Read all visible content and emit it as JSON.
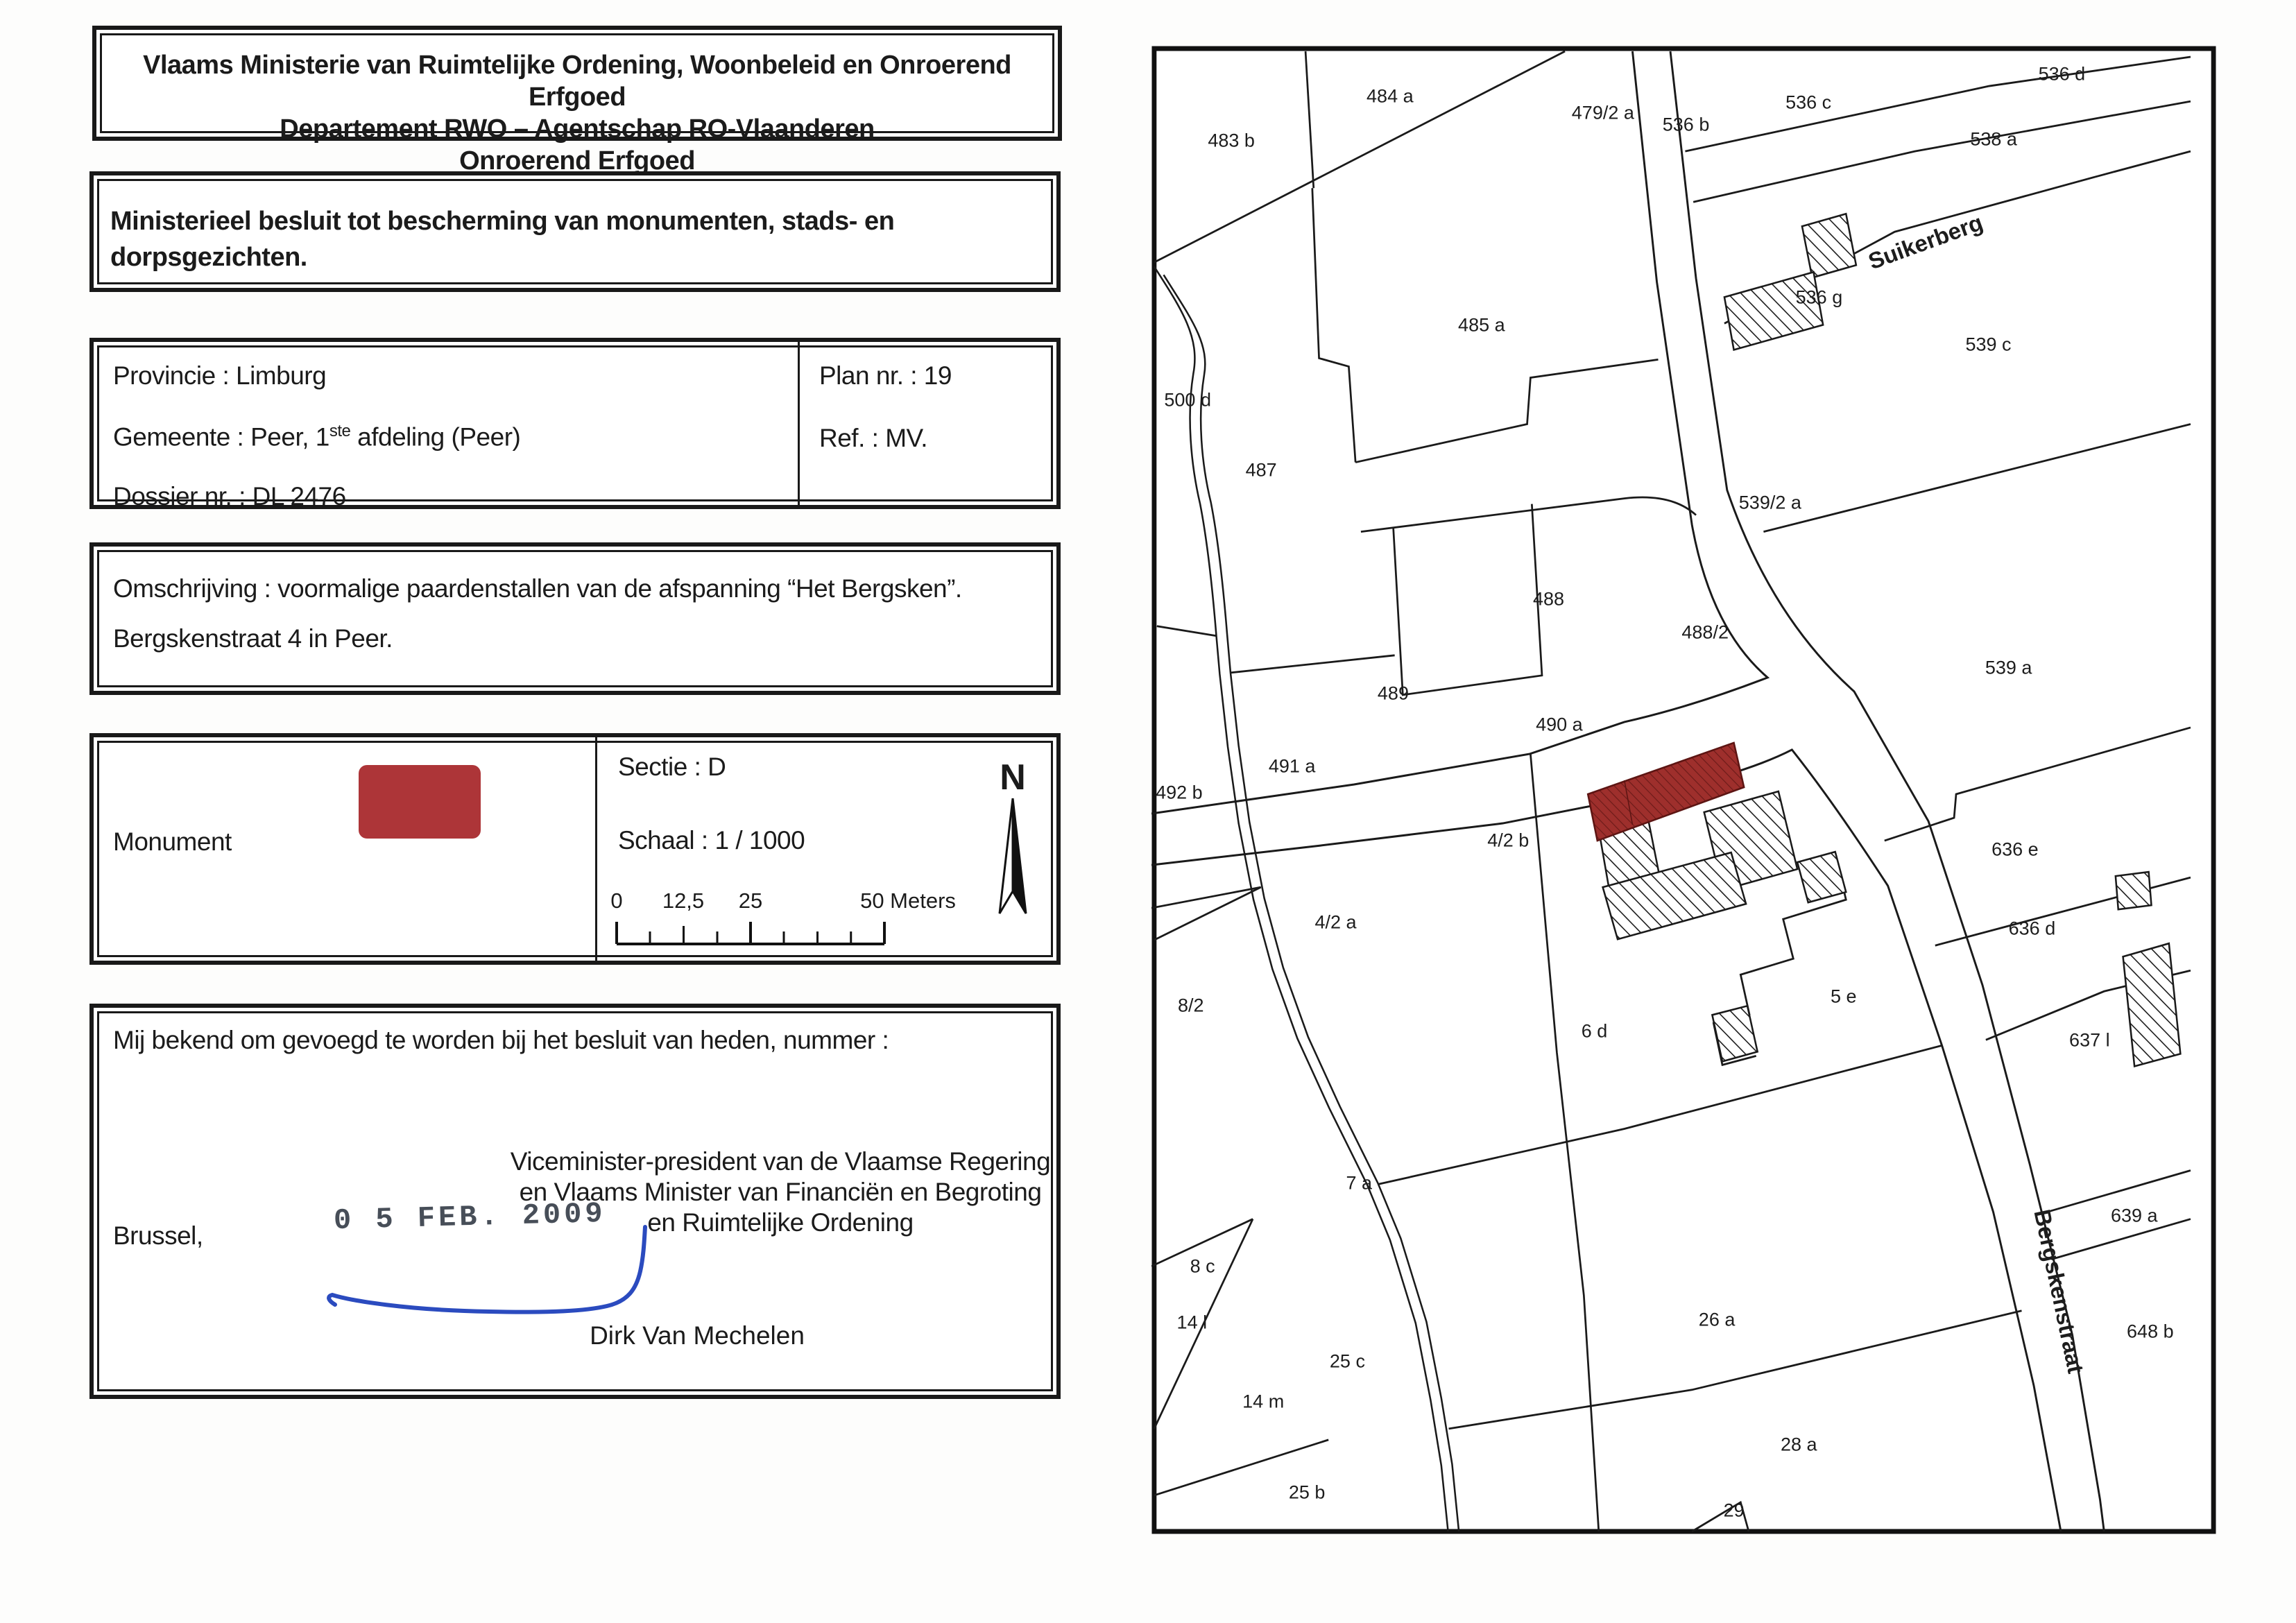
{
  "document": {
    "header_lines": [
      "Vlaams Ministerie van Ruimtelijke Ordening, Woonbeleid en Onroerend Erfgoed",
      "Departement RWO – Agentschap RO-Vlaanderen",
      "Onroerend Erfgoed"
    ],
    "decree_title_line1": "Ministerieel besluit tot bescherming van monumenten, stads- en",
    "decree_title_line2": "dorpsgezichten.",
    "info": {
      "provincie": "Provincie : Limburg",
      "gemeente_prefix": "Gemeente : Peer, 1",
      "gemeente_sup": "ste",
      "gemeente_suffix": " afdeling (Peer)",
      "dossier": "Dossier nr. : DL 2476",
      "plan": "Plan nr. : 19",
      "ref": "Ref. : MV."
    },
    "omschrijving_line1": "Omschrijving : voormalige paardenstallen van de afspanning “Het Bergsken”.",
    "omschrijving_line2": "Bergskenstraat 4 in Peer.",
    "legend": {
      "monument_label": "Monument",
      "swatch_color": "#ad3538",
      "sectie": "Sectie : D",
      "schaal": "Schaal : 1 / 1000",
      "scalebar_labels": [
        "0",
        "12,5",
        "25",
        "50 Meters"
      ],
      "north_label": "N"
    },
    "closing": {
      "line1": "Mij bekend om gevoegd te worden bij het besluit van heden, nummer :",
      "city": "Brussel,",
      "stamp": "0 5 FEB. 2009",
      "minister_lines": [
        "Viceminister-president van de Vlaamse Regering",
        "en Vlaams Minister van Financiën en Begroting",
        "en Ruimtelijke Ordening"
      ],
      "signer": "Dirk Van Mechelen"
    }
  },
  "map": {
    "monument_color": "#9e2f2c",
    "monument_hatch_color": "#6d1b19",
    "parcel_labels": [
      {
        "text": "483 b",
        "x": 7.5,
        "y": 6.4
      },
      {
        "text": "484 a",
        "x": 22.4,
        "y": 3.4
      },
      {
        "text": "479/2 a",
        "x": 42.4,
        "y": 4.5
      },
      {
        "text": "536 b",
        "x": 50.2,
        "y": 5.3
      },
      {
        "text": "536 c",
        "x": 61.7,
        "y": 3.8
      },
      {
        "text": "536 d",
        "x": 85.5,
        "y": 1.9
      },
      {
        "text": "538 a",
        "x": 79.1,
        "y": 6.3
      },
      {
        "text": "536 g",
        "x": 62.7,
        "y": 16.9
      },
      {
        "text": "539 c",
        "x": 78.6,
        "y": 20.1
      },
      {
        "text": "485 a",
        "x": 31.0,
        "y": 18.8
      },
      {
        "text": "500 d",
        "x": 3.4,
        "y": 23.8
      },
      {
        "text": "487",
        "x": 10.3,
        "y": 28.5
      },
      {
        "text": "539/2 a",
        "x": 58.1,
        "y": 30.7
      },
      {
        "text": "488",
        "x": 37.3,
        "y": 37.2
      },
      {
        "text": "488/2",
        "x": 52.0,
        "y": 39.4
      },
      {
        "text": "539 a",
        "x": 80.5,
        "y": 41.8
      },
      {
        "text": "489",
        "x": 22.7,
        "y": 43.5
      },
      {
        "text": "490 a",
        "x": 38.3,
        "y": 45.6
      },
      {
        "text": "491 a",
        "x": 13.2,
        "y": 48.4
      },
      {
        "text": "492 b",
        "x": 2.6,
        "y": 50.2
      },
      {
        "text": "4/2 b",
        "x": 33.5,
        "y": 53.4
      },
      {
        "text": "4/2 a",
        "x": 17.3,
        "y": 58.9
      },
      {
        "text": "8/2",
        "x": 3.7,
        "y": 64.5
      },
      {
        "text": "636 e",
        "x": 81.1,
        "y": 54.0
      },
      {
        "text": "636 d",
        "x": 82.7,
        "y": 59.3
      },
      {
        "text": "637 l",
        "x": 88.1,
        "y": 66.8
      },
      {
        "text": "5 e",
        "x": 65.0,
        "y": 63.9
      },
      {
        "text": "6 d",
        "x": 41.6,
        "y": 66.2
      },
      {
        "text": "7 a",
        "x": 19.5,
        "y": 76.4
      },
      {
        "text": "8 c",
        "x": 4.8,
        "y": 82.0
      },
      {
        "text": "26 a",
        "x": 53.1,
        "y": 85.6
      },
      {
        "text": "14 l",
        "x": 3.8,
        "y": 85.8
      },
      {
        "text": "25 c",
        "x": 18.4,
        "y": 88.4
      },
      {
        "text": "14 m",
        "x": 10.5,
        "y": 91.1
      },
      {
        "text": "25 b",
        "x": 14.6,
        "y": 97.2
      },
      {
        "text": "28 a",
        "x": 60.8,
        "y": 94.0
      },
      {
        "text": "29",
        "x": 54.7,
        "y": 98.4
      },
      {
        "text": "639 a",
        "x": 92.3,
        "y": 78.6
      },
      {
        "text": "648 b",
        "x": 93.8,
        "y": 86.4
      }
    ],
    "street_labels": [
      {
        "text": "Suikerberg",
        "x": 72.7,
        "y": 13.2,
        "rot": -20
      },
      {
        "text": "Bergskenstraat",
        "x": 85.2,
        "y": 83.7,
        "rot": 78
      }
    ]
  }
}
